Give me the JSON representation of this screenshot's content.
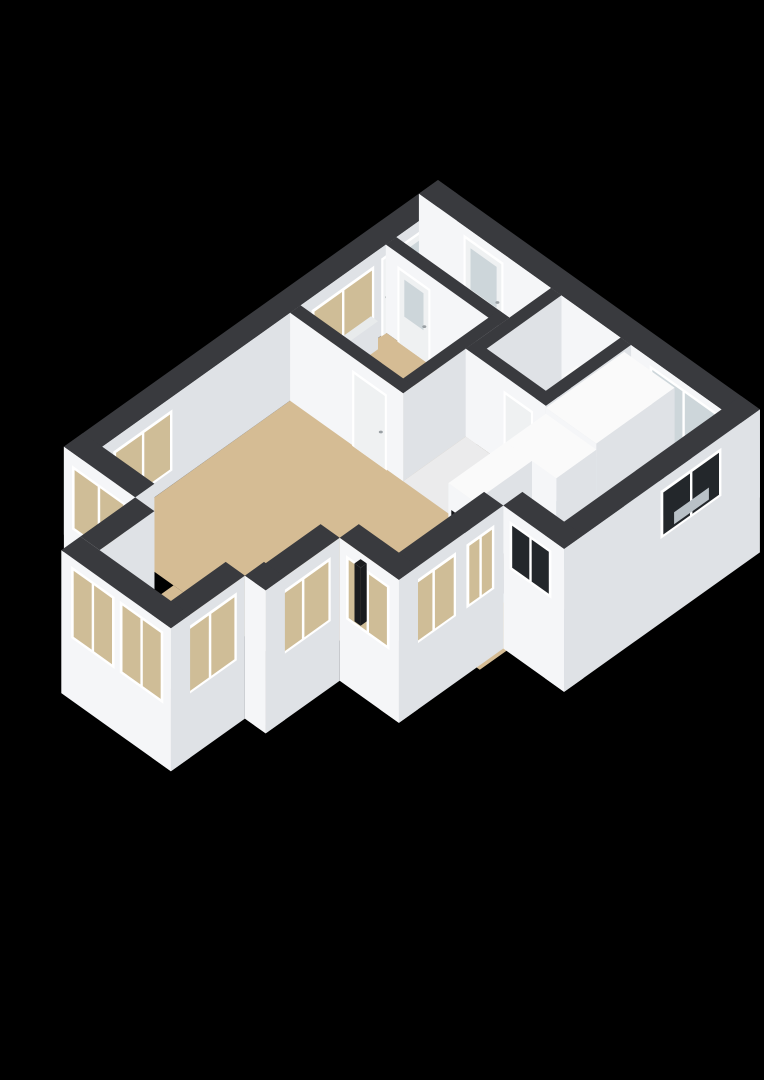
{
  "view": {
    "description": "3d-isometric-floorplan",
    "background": "#000000",
    "width": 764,
    "height": 1080
  },
  "colors": {
    "bg": "#000000",
    "cap": "#393a3e",
    "wall_sw": "#f5f6f8",
    "wall_se": "#dfe2e6",
    "wall_top": "#fafafa",
    "floor_tan": "#d5bc94",
    "floor_blue": "#c5cfdc",
    "floor_gray": "#ebebec",
    "floor_white": "#f2f2f3",
    "frame": "#ffffff",
    "door": "#eff1f2",
    "glass_tan": "#cfbd97",
    "glass_frost": "#cdd6da",
    "glass_dark": "#23272b",
    "steel": "#b9c1c7",
    "steel_dark": "#9aa3a8",
    "burner": "#596066",
    "handle": "#9aa0a4",
    "niche": "#141518",
    "dark_obj": "#1a1c1f",
    "radiator": "#e8ebec"
  },
  "scene": {
    "proj": {
      "ox": 438,
      "oy": 268,
      "kx": 0.87,
      "ky": 0.62
    },
    "primitives": [
      {
        "n": "kitchen-floor",
        "k": "floor",
        "pts": [
          [
            244,
            22
          ],
          [
            348,
            22
          ],
          [
            348,
            205
          ],
          [
            244,
            298
          ]
        ],
        "f": "floor_blue"
      },
      {
        "n": "living-room-floor-southeast",
        "k": "floor",
        "pts": [
          [
            232,
            292
          ],
          [
            348,
            200
          ],
          [
            348,
            300
          ],
          [
            278,
            300
          ],
          [
            278,
            330
          ],
          [
            232,
            330
          ]
        ],
        "f": "floor_tan"
      },
      {
        "n": "living-room-floor",
        "k": "floor",
        "pts": [
          [
            22,
            120
          ],
          [
            244,
            120
          ],
          [
            244,
            408
          ],
          [
            22,
            408
          ]
        ],
        "f": "floor_tan"
      },
      {
        "n": "bay-floor",
        "k": "floor",
        "pts": [
          [
            104,
            408
          ],
          [
            186,
            408
          ],
          [
            186,
            493
          ],
          [
            104,
            493
          ]
        ],
        "f": "floor_tan"
      },
      {
        "n": "corridor-floor",
        "k": "floor",
        "pts": [
          [
            152,
            120
          ],
          [
            244,
            120
          ],
          [
            244,
            192
          ],
          [
            152,
            192
          ]
        ],
        "f": "floor_gray"
      },
      {
        "n": "hall-floor",
        "k": "floor",
        "pts": [
          [
            22,
            22
          ],
          [
            152,
            22
          ],
          [
            152,
            70
          ],
          [
            22,
            70
          ]
        ],
        "f": "floor_gray"
      },
      {
        "n": "toilet-floor",
        "k": "floor",
        "pts": [
          [
            164,
            22
          ],
          [
            232,
            22
          ],
          [
            232,
            108
          ],
          [
            164,
            108
          ]
        ],
        "f": "floor_white"
      },
      {
        "n": "bedroom-floor",
        "k": "floor",
        "pts": [
          [
            22,
            82
          ],
          [
            140,
            82
          ],
          [
            140,
            180
          ],
          [
            22,
            180
          ]
        ],
        "f": "floor_tan"
      },
      {
        "n": "facade-northwest-wall",
        "k": "prism",
        "r": [
          0,
          0,
          22,
          430
        ],
        "z": [
          0,
          88
        ]
      },
      {
        "n": "bedroom-garden-door",
        "k": "udoor",
        "p": 22.7,
        "a": [
          34,
          88
        ],
        "z": [
          0,
          78
        ],
        "glass": "glass_frost"
      },
      {
        "n": "bedroom-window",
        "k": "uwin",
        "p": 22.7,
        "a": [
          96,
          168
        ],
        "z": [
          18,
          76
        ],
        "glass": "glass_tan"
      },
      {
        "n": "radiator",
        "k": "prism",
        "r": [
          23,
          100,
          31,
          164
        ],
        "z": [
          0,
          28
        ],
        "c": {
          "top": "radiator",
          "se": "wall_se",
          "sw": "radiator"
        }
      },
      {
        "n": "living-room-window-northwest",
        "k": "uwin",
        "p": 22.7,
        "a": [
          328,
          396
        ],
        "z": [
          15,
          76
        ],
        "glass": "glass_tan"
      },
      {
        "n": "facade-northeast-wall",
        "k": "prism",
        "r": [
          0,
          0,
          370,
          22
        ],
        "z": [
          0,
          88
        ]
      },
      {
        "n": "front-door",
        "k": "vdoor",
        "p": 22.7,
        "a": [
          52,
          98
        ],
        "z": [
          0,
          80
        ],
        "glass": "glass_frost"
      },
      {
        "n": "french-doors",
        "k": "vwin",
        "p": 22.7,
        "a": [
          266,
          344
        ],
        "z": [
          2,
          82
        ],
        "glass": "glass_frost"
      },
      {
        "n": "bedroom-north-wall",
        "k": "prism",
        "r": [
          22,
          70,
          152,
          82
        ],
        "z": [
          0,
          88
        ]
      },
      {
        "n": "bedroom-hall-door",
        "k": "vdoor",
        "p": 82.7,
        "a": [
          36,
          74
        ],
        "z": [
          0,
          76
        ],
        "glass": "glass_frost"
      },
      {
        "n": "bedroom-east-wall",
        "k": "prism",
        "r": [
          140,
          70,
          152,
          192
        ],
        "z": [
          0,
          88
        ]
      },
      {
        "n": "bedroom-south-wall",
        "k": "prism",
        "r": [
          22,
          180,
          152,
          192
        ],
        "z": [
          0,
          88
        ]
      },
      {
        "n": "bedroom-door",
        "k": "vdoor",
        "p": 192.7,
        "a": [
          94,
          134
        ],
        "z": [
          0,
          76
        ],
        "glass": null
      },
      {
        "n": "hall-toilet-wall",
        "k": "prism",
        "r": [
          152,
          22,
          164,
          120
        ],
        "z": [
          0,
          88
        ]
      },
      {
        "n": "toilet-cistern",
        "k": "prism",
        "r": [
          186,
          26,
          214,
          42
        ],
        "z": [
          0,
          34
        ],
        "c": {
          "top": "wall_top",
          "se": "wall_se",
          "sw": "wall_sw"
        }
      },
      {
        "n": "toilet-bowl",
        "k": "prism",
        "r": [
          190,
          42,
          210,
          60
        ],
        "z": [
          0,
          28
        ],
        "c": {
          "top": "wall_top",
          "se": "wall_se",
          "sw": "wall_sw"
        }
      },
      {
        "n": "toilet-seat",
        "k": "hquad",
        "r": [
          192,
          44,
          208,
          58
        ],
        "z": 29,
        "f": "dark_obj"
      },
      {
        "n": "toilet-kitchen-wall",
        "k": "prism",
        "r": [
          232,
          22,
          244,
          130
        ],
        "z": [
          0,
          88
        ]
      },
      {
        "n": "toilet-south-wall",
        "k": "prism",
        "r": [
          152,
          108,
          244,
          120
        ],
        "z": [
          0,
          88
        ]
      },
      {
        "n": "toilet-door",
        "k": "vdoor",
        "p": 120.7,
        "a": [
          196,
          230
        ],
        "z": [
          0,
          74
        ],
        "glass": null
      },
      {
        "n": "kitchen-tall-cabinet",
        "k": "prism",
        "r": [
          244,
          30,
          302,
          120
        ],
        "z": [
          0,
          86
        ],
        "c": {
          "top": "wall_top",
          "se": "wall_se",
          "sw": "wall_sw"
        }
      },
      {
        "n": "kitchen-cabinet",
        "k": "prism",
        "r": [
          244,
          120,
          302,
          166
        ],
        "z": [
          0,
          80
        ],
        "c": {
          "top": "wall_top",
          "se": "wall_se",
          "sw": "wall_sw"
        }
      },
      {
        "n": "kitchen-oven-column",
        "k": "prism",
        "r": [
          244,
          166,
          274,
          232
        ],
        "z": [
          0,
          80
        ],
        "c": {
          "top": "wall_top",
          "se": "wall_se",
          "sw": "wall_sw"
        }
      },
      {
        "n": "oven-niche",
        "k": "vquad",
        "p": 232.7,
        "a": [
          248,
          270
        ],
        "z": [
          28,
          56
        ],
        "f": "niche"
      },
      {
        "n": "kitchen-low-cabinet",
        "k": "prism",
        "r": [
          244,
          232,
          274,
          268
        ],
        "z": [
          0,
          42
        ],
        "c": {
          "top": "wall_top",
          "se": "wall_se",
          "sw": "wall_sw"
        }
      },
      {
        "n": "kitchen-counter",
        "k": "prism",
        "r": [
          320,
          40,
          348,
          203
        ],
        "z": [
          0,
          40
        ],
        "c": {
          "top": "dark_obj",
          "se": "glass_dark",
          "sw": "wall_sw"
        }
      },
      {
        "n": "kitchen-sink-rim",
        "k": "hquad",
        "r": [
          325,
          78,
          344,
          118
        ],
        "z": 41,
        "f": "steel"
      },
      {
        "n": "kitchen-sink-basin",
        "k": "hquad",
        "r": [
          328,
          84,
          341,
          112
        ],
        "z": 41.5,
        "f": "steel_dark"
      },
      {
        "n": "kitchen-faucet",
        "k": "disc",
        "u": 334,
        "v": 72,
        "z": 44,
        "rx": 3,
        "ry": 2.2,
        "f": "steel"
      },
      {
        "n": "cooktop-counter",
        "k": "prism",
        "r": [
          300,
          195,
          348,
          225
        ],
        "z": [
          0,
          40
        ],
        "c": {
          "top": "dark_obj",
          "se": "wall_se",
          "sw": "dark_obj"
        }
      },
      {
        "n": "burner-1",
        "k": "disc",
        "u": 314,
        "v": 204,
        "z": 41,
        "rx": 4.5,
        "ry": 2.8,
        "f": "burner"
      },
      {
        "n": "burner-2",
        "k": "disc",
        "u": 314,
        "v": 217,
        "z": 41,
        "rx": 4.5,
        "ry": 2.8,
        "f": "burner"
      },
      {
        "n": "burner-3",
        "k": "disc",
        "u": 332,
        "v": 204,
        "z": 41,
        "rx": 4.5,
        "ry": 2.8,
        "f": "burner"
      },
      {
        "n": "burner-4",
        "k": "disc",
        "u": 332,
        "v": 217,
        "z": 41,
        "rx": 4.5,
        "ry": 2.8,
        "f": "burner"
      },
      {
        "n": "facade-southeast-kitchen-wall",
        "k": "prism",
        "r": [
          348,
          0,
          370,
          225
        ],
        "z": [
          -55,
          88
        ]
      },
      {
        "n": "kitchen-sink-window",
        "k": "uwin",
        "p": 370.7,
        "a": [
          45,
          115
        ],
        "z": [
          30,
          78
        ],
        "glass": "glass_dark"
      },
      {
        "n": "sink-through-window",
        "k": "uquad",
        "p": 371.4,
        "a": [
          60,
          100
        ],
        "z": [
          36,
          48
        ],
        "f": "steel"
      },
      {
        "n": "facade-south-kitchen-wall",
        "k": "prism",
        "r": [
          300,
          203,
          370,
          225
        ],
        "z": [
          -55,
          88
        ]
      },
      {
        "n": "kitchen-stove-window",
        "k": "vwin",
        "p": 225.7,
        "a": [
          308,
          356
        ],
        "z": [
          30,
          78
        ],
        "glass": "glass_dark"
      },
      {
        "n": "facade-east-living-wall",
        "k": "prism",
        "r": [
          278,
          225,
          300,
          345
        ],
        "z": [
          -55,
          88
        ]
      },
      {
        "n": "living-window-east-1",
        "k": "uwin",
        "p": 300.7,
        "a": [
          236,
          268
        ],
        "z": [
          12,
          76
        ],
        "glass": "glass_tan"
      },
      {
        "n": "living-window-east-2",
        "k": "uwin",
        "p": 300.7,
        "a": [
          280,
          332
        ],
        "z": [
          12,
          76
        ],
        "glass": "glass_tan"
      },
      {
        "n": "facade-south-living-wall",
        "k": "prism",
        "r": [
          232,
          323,
          300,
          345
        ],
        "z": [
          -55,
          88
        ]
      },
      {
        "n": "living-window-south-east",
        "k": "vwin",
        "p": 345.7,
        "a": [
          240,
          290
        ],
        "z": [
          12,
          76
        ],
        "glass": "glass_tan"
      },
      {
        "n": "facade-east-step-wall",
        "k": "prism",
        "r": [
          210,
          345,
          232,
          430
        ],
        "z": [
          -55,
          88
        ]
      },
      {
        "n": "living-window-step",
        "k": "uwin",
        "p": 232.7,
        "a": [
          356,
          420
        ],
        "z": [
          12,
          76
        ],
        "glass": "glass_tan"
      },
      {
        "n": "facade-south-shoulder-wall",
        "k": "prism",
        "r": [
          208,
          408,
          232,
          430
        ],
        "z": [
          -55,
          88
        ]
      },
      {
        "n": "facade-south-west-wall",
        "k": "prism",
        "r": [
          0,
          408,
          82,
          430
        ],
        "z": [
          -55,
          88
        ]
      },
      {
        "n": "living-window-south-west",
        "k": "vwin",
        "p": 430.7,
        "a": [
          10,
          72
        ],
        "z": [
          12,
          76
        ],
        "glass": "glass_tan"
      },
      {
        "n": "bay-west-wall",
        "k": "prism",
        "r": [
          82,
          430,
          104,
          493
        ],
        "z": [
          -55,
          88
        ]
      },
      {
        "n": "bay-east-wall",
        "k": "prism",
        "r": [
          186,
          430,
          208,
          515
        ],
        "z": [
          -55,
          88
        ]
      },
      {
        "n": "bay-window-east",
        "k": "uwin",
        "p": 208.7,
        "a": [
          440,
          502
        ],
        "z": [
          10,
          78
        ],
        "glass": "glass_tan"
      },
      {
        "n": "bay-front-wall",
        "k": "prism",
        "r": [
          82,
          493,
          208,
          515
        ],
        "z": [
          -55,
          88
        ]
      },
      {
        "n": "bay-window-1",
        "k": "vwin",
        "p": 515.7,
        "a": [
          94,
          144
        ],
        "z": [
          8,
          80
        ],
        "glass": "glass_tan"
      },
      {
        "n": "bay-window-2",
        "k": "vwin",
        "p": 515.7,
        "a": [
          150,
          200
        ],
        "z": [
          8,
          80
        ],
        "glass": "glass_tan"
      },
      {
        "n": "stove-pipe",
        "k": "prism",
        "r": [
          237,
          326,
          244,
          333
        ],
        "z": [
          0,
          58
        ],
        "c": {
          "top": "dark_obj",
          "se": "dark_obj",
          "sw": "dark_obj"
        }
      },
      {
        "n": "stove-pipe-top",
        "k": "disc",
        "u": 240.5,
        "v": 329.5,
        "z": 58,
        "rx": 4,
        "ry": 2.5,
        "f": "dark_obj"
      }
    ]
  }
}
